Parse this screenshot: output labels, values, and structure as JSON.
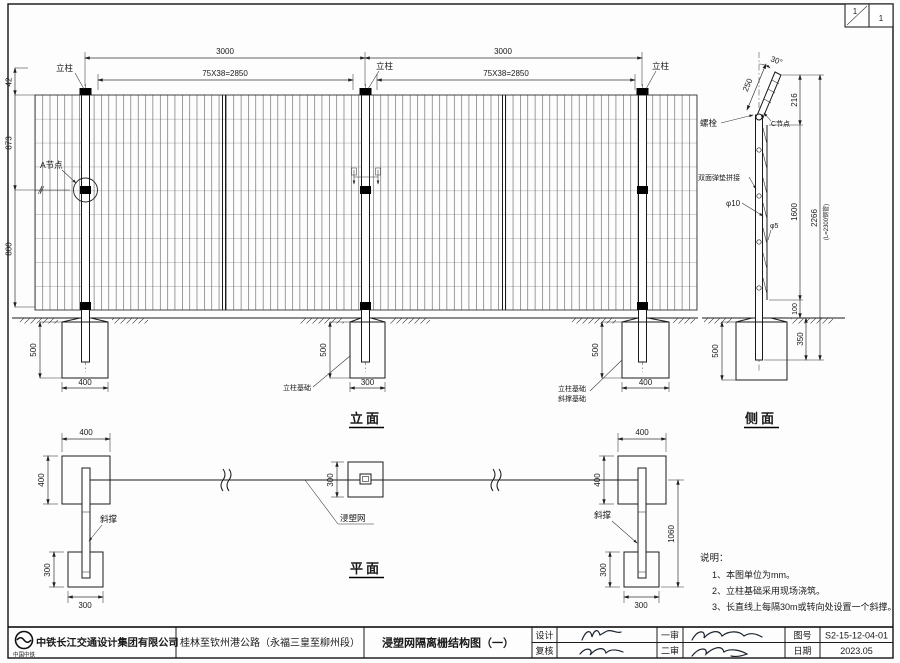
{
  "corner": {
    "sheet_no": "1",
    "sheet_total": "1"
  },
  "elevation": {
    "title": "立面",
    "dim_span": "3000",
    "dim_mesh": "75X38=2850",
    "dim_top": "42",
    "dim_upper": "873",
    "dim_lower": "800",
    "dim_found_depth": "500",
    "dim_found_w400": "400",
    "dim_found_w300": "300",
    "label_post": "立柱",
    "label_node_a": "A节点",
    "label_post_found": "立柱基础",
    "label_brace_found": "斜撑基础"
  },
  "side": {
    "title": "侧面",
    "dim_angle": "30°",
    "dim_arm": "250",
    "dim_216": "216",
    "dim_1600": "1600",
    "dim_100": "100",
    "dim_350": "350",
    "dim_2266": "2266",
    "dim_2266_note": "(L=2300钢管)",
    "dim_found_depth": "500",
    "label_bolt": "螺栓",
    "label_node_c": "C节点",
    "label_splice": "双面弹垫拼接",
    "label_phi10": "φ10",
    "label_phi5": "φ5"
  },
  "plan": {
    "title": "平面",
    "dim_400": "400",
    "dim_300": "300",
    "dim_1060": "1060",
    "label_brace": "斜撑",
    "label_mesh": "浸塑网"
  },
  "notes": {
    "title": "说明：",
    "item1": "1、本图单位为mm。",
    "item2": "2、立柱基础采用现场浇筑。",
    "item3": "3、长直线上每隔30m或转向处设置一个斜撑。"
  },
  "titleblock": {
    "logo_text": "中国中铁",
    "company": "中铁长江交通设计集团有限公司",
    "project": "桂林至钦州港公路（永福三皇至柳州段）",
    "drawing_title": "浸塑网隔离栅结构图（一）",
    "design_label": "设计",
    "check_label": "复核",
    "review1_label": "一审",
    "review2_label": "二审",
    "no_label": "图号",
    "drawing_no": "S2-15-12-04-01",
    "date_label": "日期",
    "date": "2023.05"
  }
}
